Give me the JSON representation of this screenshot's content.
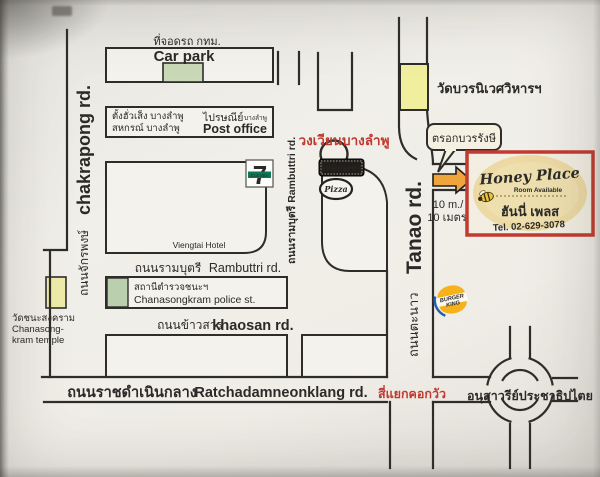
{
  "colors": {
    "paper": "#f0eee8",
    "ink": "#2f2d2a",
    "red_text": "#c0392f",
    "car_park_green": "#c9d8b7",
    "police_green": "#b9cfae",
    "temple_yellow": "#eeeca8",
    "wat_yellow": "#f1ef9e",
    "arrow_orange": "#f0a43c",
    "honey_border_red": "#c23a30",
    "honey_oval_beige": "#ecd9a4",
    "honey_blue": "#23479c",
    "honey_red": "#cc3333"
  },
  "labels": {
    "car_park": {
      "thai": "ที่จอดรถ กทม.",
      "en": "Car park"
    },
    "department_store": {
      "line1": "ตั้งฮั่วเส็ง บางลำพู",
      "line2": "สหกรณ์ บางลำพู"
    },
    "post_office": {
      "thai": "ไปรษณีย์",
      "thai_small": "บางลำพู",
      "en": "Post office"
    },
    "chakrapong_road": {
      "thai": "ถนนจักรพงษ์",
      "en": "chakrapong rd."
    },
    "rambuttri_road_vertical": {
      "text": "ถนนรามบุตรี  Rambuttri rd."
    },
    "banglamphu_circle": {
      "thai": "วงเวียนบางลำพู"
    },
    "wat_bowonniwet": {
      "thai": "วัดบวรนิเวศวิหารฯ"
    },
    "trok_bowon_rangsi": {
      "thai": "ตรอกบวรรังษี"
    },
    "distance": {
      "en": "10 m./",
      "thai": "10 เมตร"
    },
    "tanao_road": {
      "thai": "ถนนตะนาว",
      "en": "Tanao rd."
    },
    "viengtai_hotel": {
      "en": "Viengtai Hotel"
    },
    "rambuttri_road_horizontal": {
      "thai": "ถนนรามบุตรี",
      "en": "Rambuttri rd."
    },
    "police_station": {
      "thai": "สถานีตำรวจชนะฯ",
      "en": "Chanasongkram police st."
    },
    "khaosan_road": {
      "thai": "ถนนข้าวสาร",
      "en": "khaosan rd."
    },
    "chanasongkram_temple": {
      "thai": "วัดชนะสงคราม",
      "en1": "Chanasong-",
      "en2": "kram temple"
    },
    "ratchadamnoen_road": {
      "thai": "ถนนราชดำเนินกลาง",
      "en": "Ratchadamneonklang rd."
    },
    "kok_wua_intersection": {
      "thai": "สี่แยกคอกวัว"
    },
    "democracy_monument": {
      "thai": "อนุสาวรีย์ประชาธิปไตย"
    }
  },
  "logos": {
    "seven_eleven": {
      "seven": "7",
      "eleven": "ELEVEn"
    },
    "swensens_banner": {
      "text": "Swensen's"
    },
    "pizza_oval": {
      "text": "Pizza"
    },
    "burger_king": {
      "line1": "BURGER",
      "line2": "KING"
    },
    "honey_place": {
      "title": "Honey Place",
      "subtitle": "Room Available",
      "thai": "ฮันนี่ เพลส",
      "tel": "Tel. 02-629-3078"
    }
  }
}
